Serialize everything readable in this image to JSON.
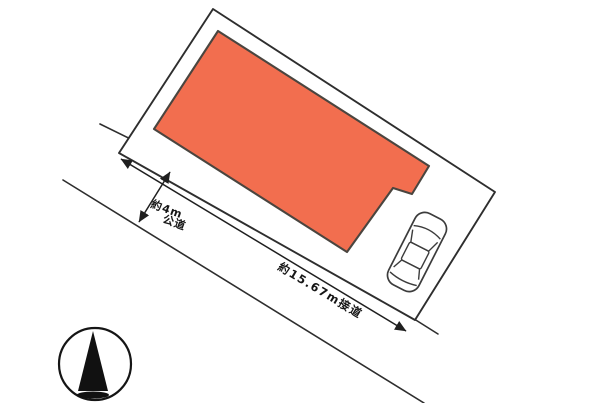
{
  "site_plan": {
    "labels": {
      "road_width": "約4m",
      "road_kind": "公道",
      "frontage": "約15.67m接道"
    },
    "measurements": {
      "road_width_m": 4,
      "frontage_m": 15.67
    },
    "colors": {
      "building_fill": "#F26E4F",
      "line": "#2E2E2E",
      "background": "#FFFFFF"
    },
    "compass": {
      "direction": "N"
    },
    "objects": {
      "boundary": "site-boundary",
      "building": "building-footprint",
      "car": "car-top-view",
      "road": "public-road"
    }
  }
}
